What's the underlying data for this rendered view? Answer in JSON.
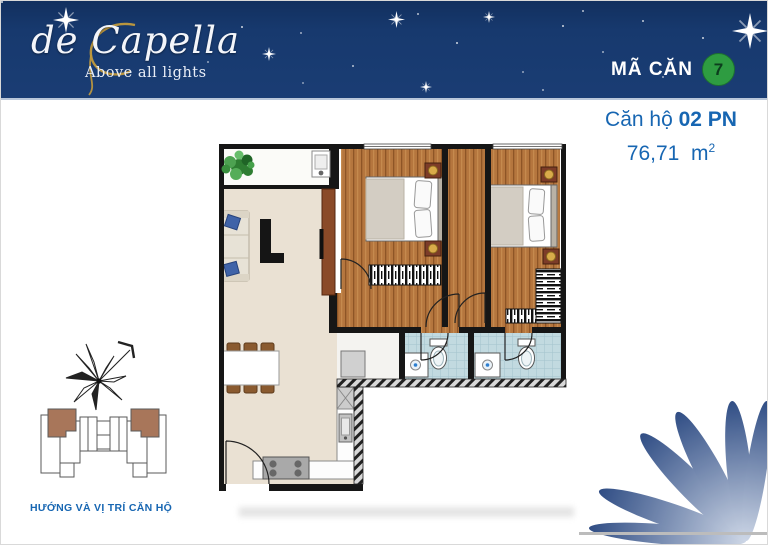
{
  "header": {
    "logo": {
      "text": "de Capella",
      "tagline": "Above all lights"
    },
    "unit_code": {
      "label": "MÃ CĂN",
      "value": "7"
    },
    "bg_color": "#17396e",
    "badge_color": "#2e9c41"
  },
  "unit_info": {
    "name_regular": "Căn hộ",
    "name_bold": "02 PN",
    "area_value": "76,71",
    "area_unit": "m",
    "area_exponent": "2",
    "text_color": "#1766b2"
  },
  "key_plan": {
    "caption": "HƯỚNG VÀ VỊ TRÍ CĂN HỘ"
  },
  "colors": {
    "accent_blue": "#1766b2",
    "petal_blue": "#1e3e7a",
    "wood_floor": "#b5763e",
    "beige_floor": "#eae1d3",
    "tile_blue": "#c2dae0",
    "wall_black": "#161616",
    "highlight_unit_brown": "#a8765a"
  }
}
